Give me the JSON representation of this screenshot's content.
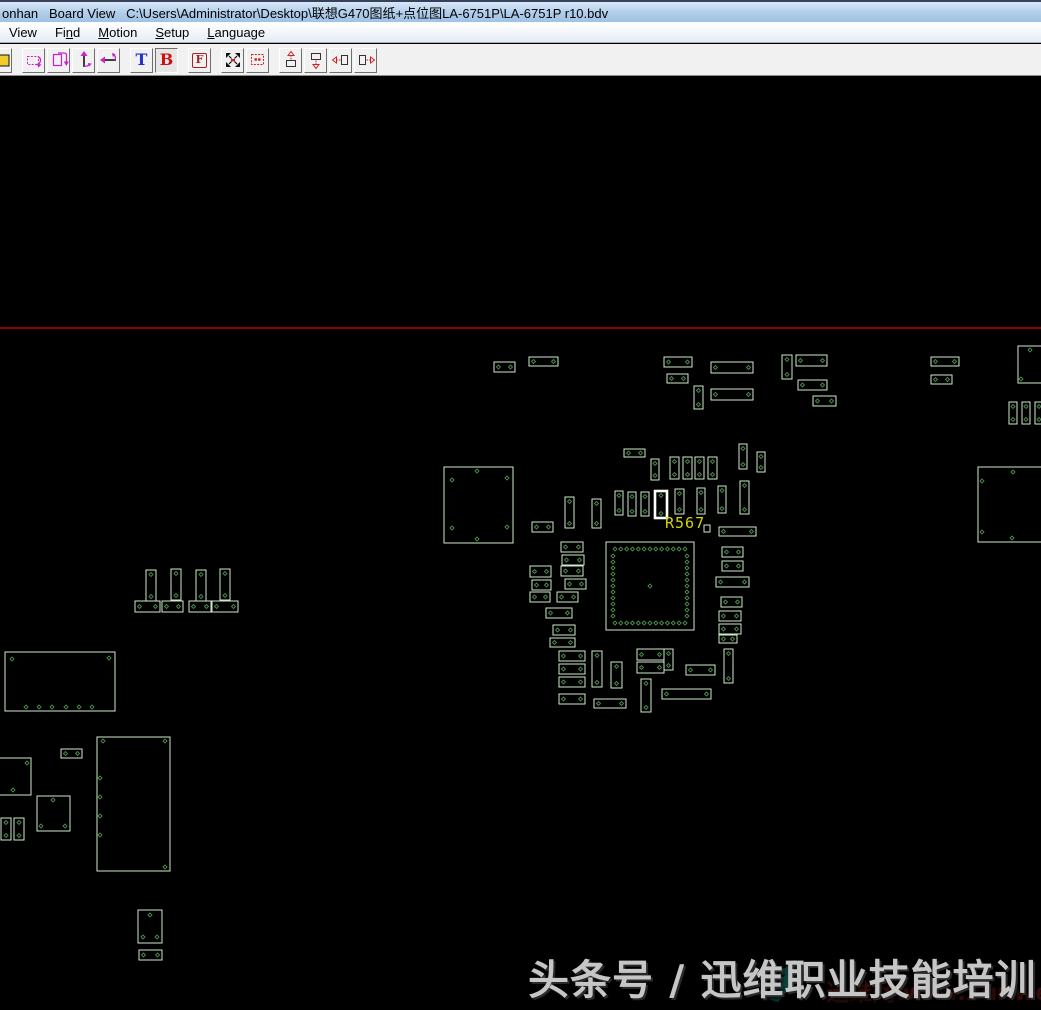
{
  "window": {
    "title": "onhan   Board View   C:\\Users\\Administrator\\Desktop\\联想G470图纸+点位图LA-6751P\\LA-6751P r10.bdv"
  },
  "menu": {
    "items": [
      {
        "pre": "View",
        "key": "",
        "post": ""
      },
      {
        "pre": "Fi",
        "key": "n",
        "post": "d"
      },
      {
        "pre": "",
        "key": "M",
        "post": "otion"
      },
      {
        "pre": "",
        "key": "S",
        "post": "etup"
      },
      {
        "pre": "",
        "key": "L",
        "post": "anguage"
      }
    ]
  },
  "toolbar": {
    "letters": {
      "top": "T",
      "bottom": "B",
      "flip": "F"
    },
    "active_view": "B",
    "icons": [
      "open-file-icon",
      "rotate-part-icon",
      "flip-board-icon",
      "flip-vertical-icon",
      "flip-horizontal-icon",
      "top-view-letter",
      "bottom-view-letter",
      "mirror-letter",
      "zoom-fit-icon",
      "zoom-selection-icon",
      "pan-up-icon",
      "pan-down-icon",
      "pan-left-icon",
      "pan-right-icon"
    ]
  },
  "board": {
    "colors": {
      "background": "#000000",
      "outline": "#cfe9cb",
      "pin": "#4e8e4e",
      "highlight": "#ffffff",
      "label": "#d6d600",
      "board_edge": "#bb0000"
    },
    "red_line_y": 328,
    "highlight_label": {
      "text": "R567",
      "x": 665,
      "y": 514
    },
    "components": [
      {
        "x": 494,
        "y": 362,
        "w": 21,
        "h": 10,
        "t": "h"
      },
      {
        "x": 529,
        "y": 357,
        "w": 29,
        "h": 9,
        "t": "h"
      },
      {
        "x": 664,
        "y": 357,
        "w": 28,
        "h": 10,
        "t": "h"
      },
      {
        "x": 667,
        "y": 374,
        "w": 21,
        "h": 9,
        "t": "h"
      },
      {
        "x": 694,
        "y": 386,
        "w": 9,
        "h": 23,
        "t": "v"
      },
      {
        "x": 711,
        "y": 362,
        "w": 42,
        "h": 11,
        "t": "h"
      },
      {
        "x": 711,
        "y": 389,
        "w": 42,
        "h": 11,
        "t": "h"
      },
      {
        "x": 782,
        "y": 355,
        "w": 10,
        "h": 24,
        "t": "v"
      },
      {
        "x": 796,
        "y": 355,
        "w": 31,
        "h": 11,
        "t": "h"
      },
      {
        "x": 798,
        "y": 380,
        "w": 29,
        "h": 10,
        "t": "h"
      },
      {
        "x": 813,
        "y": 396,
        "w": 23,
        "h": 10,
        "t": "h"
      },
      {
        "x": 931,
        "y": 357,
        "w": 28,
        "h": 9,
        "t": "h"
      },
      {
        "x": 931,
        "y": 375,
        "w": 21,
        "h": 9,
        "t": "h"
      },
      {
        "x": 1009,
        "y": 402,
        "w": 8,
        "h": 22,
        "t": "v"
      },
      {
        "x": 1022,
        "y": 402,
        "w": 8,
        "h": 22,
        "t": "v"
      },
      {
        "x": 1035,
        "y": 402,
        "w": 8,
        "h": 22,
        "t": "v"
      },
      {
        "x": 624,
        "y": 449,
        "w": 21,
        "h": 8,
        "t": "h"
      },
      {
        "x": 651,
        "y": 459,
        "w": 8,
        "h": 21,
        "t": "v"
      },
      {
        "x": 670,
        "y": 457,
        "w": 9,
        "h": 22,
        "t": "v"
      },
      {
        "x": 683,
        "y": 457,
        "w": 9,
        "h": 22,
        "t": "v"
      },
      {
        "x": 695,
        "y": 457,
        "w": 9,
        "h": 22,
        "t": "v"
      },
      {
        "x": 708,
        "y": 457,
        "w": 9,
        "h": 22,
        "t": "v"
      },
      {
        "x": 739,
        "y": 444,
        "w": 8,
        "h": 25,
        "t": "v"
      },
      {
        "x": 757,
        "y": 452,
        "w": 8,
        "h": 20,
        "t": "v"
      },
      {
        "x": 565,
        "y": 497,
        "w": 9,
        "h": 31,
        "t": "v"
      },
      {
        "x": 592,
        "y": 499,
        "w": 9,
        "h": 29,
        "t": "v"
      },
      {
        "x": 615,
        "y": 491,
        "w": 8,
        "h": 24,
        "t": "v"
      },
      {
        "x": 628,
        "y": 492,
        "w": 8,
        "h": 24,
        "t": "v"
      },
      {
        "x": 641,
        "y": 492,
        "w": 8,
        "h": 24,
        "t": "v"
      },
      {
        "x": 655,
        "y": 491,
        "w": 12,
        "h": 27,
        "t": "v",
        "hl": true
      },
      {
        "x": 675,
        "y": 489,
        "w": 9,
        "h": 25,
        "t": "v"
      },
      {
        "x": 697,
        "y": 488,
        "w": 8,
        "h": 26,
        "t": "v"
      },
      {
        "x": 718,
        "y": 486,
        "w": 8,
        "h": 27,
        "t": "v"
      },
      {
        "x": 740,
        "y": 481,
        "w": 9,
        "h": 33,
        "t": "v"
      },
      {
        "x": 704,
        "y": 525,
        "w": 6,
        "h": 7,
        "t": "p"
      },
      {
        "x": 719,
        "y": 527,
        "w": 37,
        "h": 9,
        "t": "h"
      },
      {
        "x": 532,
        "y": 522,
        "w": 21,
        "h": 10,
        "t": "h"
      },
      {
        "x": 561,
        "y": 542,
        "w": 22,
        "h": 10,
        "t": "h"
      },
      {
        "x": 562,
        "y": 555,
        "w": 22,
        "h": 10,
        "t": "h"
      },
      {
        "x": 530,
        "y": 566,
        "w": 21,
        "h": 11,
        "t": "h"
      },
      {
        "x": 561,
        "y": 566,
        "w": 22,
        "h": 10,
        "t": "h"
      },
      {
        "x": 532,
        "y": 580,
        "w": 19,
        "h": 10,
        "t": "h"
      },
      {
        "x": 565,
        "y": 579,
        "w": 21,
        "h": 10,
        "t": "h"
      },
      {
        "x": 530,
        "y": 592,
        "w": 20,
        "h": 10,
        "t": "h"
      },
      {
        "x": 557,
        "y": 592,
        "w": 21,
        "h": 10,
        "t": "h"
      },
      {
        "x": 546,
        "y": 608,
        "w": 26,
        "h": 10,
        "t": "h"
      },
      {
        "x": 553,
        "y": 625,
        "w": 22,
        "h": 10,
        "t": "h"
      },
      {
        "x": 550,
        "y": 638,
        "w": 25,
        "h": 9,
        "t": "h"
      },
      {
        "x": 606,
        "y": 542,
        "w": 88,
        "h": 88,
        "t": "qfp"
      },
      {
        "x": 722,
        "y": 547,
        "w": 21,
        "h": 10,
        "t": "h"
      },
      {
        "x": 722,
        "y": 561,
        "w": 21,
        "h": 10,
        "t": "h"
      },
      {
        "x": 716,
        "y": 577,
        "w": 33,
        "h": 10,
        "t": "h"
      },
      {
        "x": 721,
        "y": 597,
        "w": 21,
        "h": 10,
        "t": "h"
      },
      {
        "x": 719,
        "y": 611,
        "w": 22,
        "h": 10,
        "t": "h"
      },
      {
        "x": 719,
        "y": 624,
        "w": 22,
        "h": 10,
        "t": "h"
      },
      {
        "x": 719,
        "y": 635,
        "w": 18,
        "h": 8,
        "t": "h"
      },
      {
        "x": 559,
        "y": 651,
        "w": 26,
        "h": 10,
        "t": "h"
      },
      {
        "x": 559,
        "y": 664,
        "w": 26,
        "h": 10,
        "t": "h"
      },
      {
        "x": 559,
        "y": 677,
        "w": 26,
        "h": 10,
        "t": "h"
      },
      {
        "x": 559,
        "y": 694,
        "w": 26,
        "h": 10,
        "t": "h"
      },
      {
        "x": 592,
        "y": 651,
        "w": 10,
        "h": 36,
        "t": "v"
      },
      {
        "x": 611,
        "y": 662,
        "w": 11,
        "h": 26,
        "t": "v"
      },
      {
        "x": 594,
        "y": 699,
        "w": 32,
        "h": 9,
        "t": "h"
      },
      {
        "x": 637,
        "y": 649,
        "w": 27,
        "h": 11,
        "t": "h"
      },
      {
        "x": 637,
        "y": 662,
        "w": 27,
        "h": 11,
        "t": "h"
      },
      {
        "x": 664,
        "y": 649,
        "w": 9,
        "h": 21,
        "t": "v"
      },
      {
        "x": 641,
        "y": 679,
        "w": 10,
        "h": 33,
        "t": "v"
      },
      {
        "x": 686,
        "y": 665,
        "w": 29,
        "h": 10,
        "t": "h"
      },
      {
        "x": 662,
        "y": 689,
        "w": 49,
        "h": 10,
        "t": "h"
      },
      {
        "x": 724,
        "y": 649,
        "w": 9,
        "h": 34,
        "t": "v"
      },
      {
        "x": 146,
        "y": 570,
        "w": 10,
        "h": 31,
        "t": "v"
      },
      {
        "x": 171,
        "y": 569,
        "w": 10,
        "h": 31,
        "t": "v"
      },
      {
        "x": 196,
        "y": 570,
        "w": 10,
        "h": 31,
        "t": "v"
      },
      {
        "x": 220,
        "y": 569,
        "w": 10,
        "h": 31,
        "t": "v"
      },
      {
        "x": 135,
        "y": 601,
        "w": 25,
        "h": 11,
        "t": "h"
      },
      {
        "x": 162,
        "y": 601,
        "w": 21,
        "h": 11,
        "t": "h"
      },
      {
        "x": 189,
        "y": 601,
        "w": 22,
        "h": 11,
        "t": "h"
      },
      {
        "x": 212,
        "y": 601,
        "w": 26,
        "h": 11,
        "t": "h"
      },
      {
        "x": 5,
        "y": 652,
        "w": 110,
        "h": 59,
        "t": "c",
        "pins": [
          [
            12,
            659
          ],
          [
            109,
            658
          ],
          [
            26,
            707
          ],
          [
            39,
            707
          ],
          [
            52,
            707
          ],
          [
            66,
            707
          ],
          [
            79,
            707
          ],
          [
            92,
            707
          ]
        ]
      },
      {
        "x": 61,
        "y": 749,
        "w": 21,
        "h": 9,
        "t": "h"
      },
      {
        "x": -14,
        "y": 758,
        "w": 45,
        "h": 37,
        "t": "c",
        "pins": [
          [
            27,
            763
          ],
          [
            13,
            790
          ]
        ]
      },
      {
        "x": 37,
        "y": 796,
        "w": 33,
        "h": 35,
        "t": "c",
        "pins": [
          [
            53,
            800
          ],
          [
            41,
            826
          ],
          [
            65,
            826
          ]
        ]
      },
      {
        "x": 1,
        "y": 818,
        "w": 10,
        "h": 22,
        "t": "v"
      },
      {
        "x": 14,
        "y": 818,
        "w": 10,
        "h": 22,
        "t": "v"
      },
      {
        "x": 97,
        "y": 737,
        "w": 73,
        "h": 134,
        "t": "c",
        "pins": [
          [
            103,
            741
          ],
          [
            165,
            741
          ],
          [
            100,
            778
          ],
          [
            100,
            797
          ],
          [
            100,
            816
          ],
          [
            100,
            835
          ],
          [
            165,
            867
          ]
        ]
      },
      {
        "x": 138,
        "y": 910,
        "w": 24,
        "h": 33,
        "t": "c",
        "pins": [
          [
            150,
            915
          ],
          [
            143,
            937
          ],
          [
            157,
            937
          ]
        ]
      },
      {
        "x": 139,
        "y": 950,
        "w": 23,
        "h": 10,
        "t": "h"
      },
      {
        "x": 444,
        "y": 467,
        "w": 69,
        "h": 76,
        "t": "c",
        "pins": [
          [
            477,
            471
          ],
          [
            452,
            480
          ],
          [
            507,
            478
          ],
          [
            452,
            528
          ],
          [
            507,
            527
          ],
          [
            477,
            539
          ]
        ]
      },
      {
        "x": 1018,
        "y": 346,
        "w": 40,
        "h": 37,
        "t": "c",
        "pins": [
          [
            1030,
            350
          ],
          [
            1021,
            379
          ]
        ]
      },
      {
        "x": 978,
        "y": 467,
        "w": 70,
        "h": 75,
        "t": "c",
        "pins": [
          [
            1013,
            472
          ],
          [
            982,
            481
          ],
          [
            982,
            532
          ],
          [
            1012,
            538
          ]
        ]
      }
    ]
  },
  "watermark": {
    "main": "头条号 / 迅维职业技能培训",
    "sub": "迅维网www.xunwei.c",
    "sub_tail": "om"
  }
}
